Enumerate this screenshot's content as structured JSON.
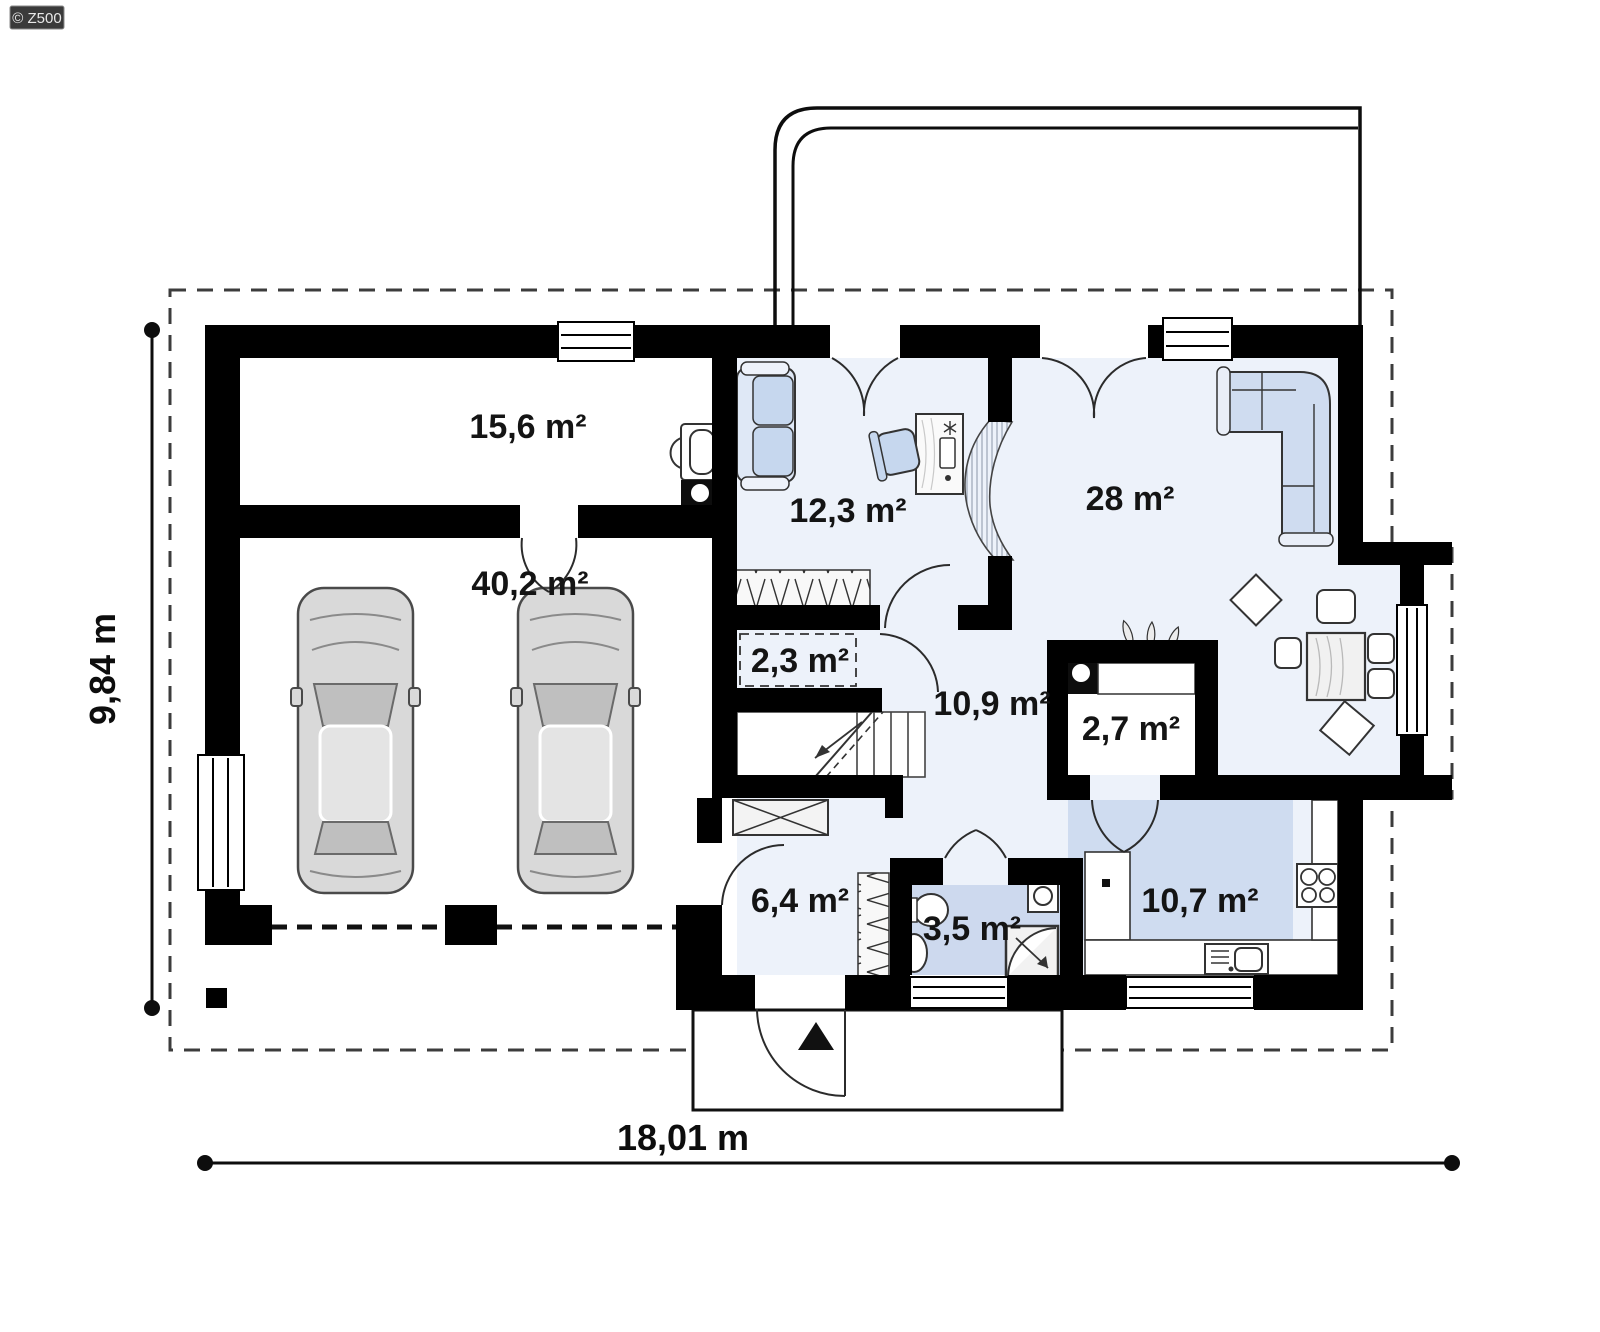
{
  "logo": {
    "text": "© Z500"
  },
  "plan_title": "Ground floor plan",
  "rooms": [
    {
      "id": "utility",
      "label": "15,6 m²"
    },
    {
      "id": "garage",
      "label": "40,2 m²"
    },
    {
      "id": "office",
      "label": "12,3 m²"
    },
    {
      "id": "living",
      "label": "28 m²"
    },
    {
      "id": "closet",
      "label": "2,3 m²"
    },
    {
      "id": "hall",
      "label": "10,9 m²"
    },
    {
      "id": "pantry",
      "label": "2,7 m²"
    },
    {
      "id": "entry",
      "label": "6,4 m²"
    },
    {
      "id": "bath",
      "label": "3,5 m²"
    },
    {
      "id": "kitchen",
      "label": "10,7 m²"
    }
  ],
  "dimensions": {
    "width": "18,01 m",
    "height": "9,84 m"
  },
  "symbols": [
    "car",
    "sofa",
    "corner-sofa",
    "desk",
    "desk-chair",
    "wardrobe-hatch",
    "stairs",
    "dining-table",
    "chair",
    "pouf",
    "fireplace-stove",
    "plant",
    "toilet",
    "sink",
    "shower",
    "washing-machine",
    "cooktop",
    "oven",
    "kitchen-counter",
    "boiler",
    "chimney-flue",
    "entrance-arrow",
    "window",
    "door-swing",
    "garage-door-dashed"
  ],
  "colors": {
    "wall": "#000000",
    "floor": "#edf2fa",
    "wet_floor": "#cdd9ee",
    "kitchen_zone": "#cfdcf0",
    "furniture_blue": "#c6d7ee",
    "car_gray": "#d9d9d9",
    "boundary_dash": "#3c3c3c",
    "logo_bg": "#3a3a3a"
  }
}
